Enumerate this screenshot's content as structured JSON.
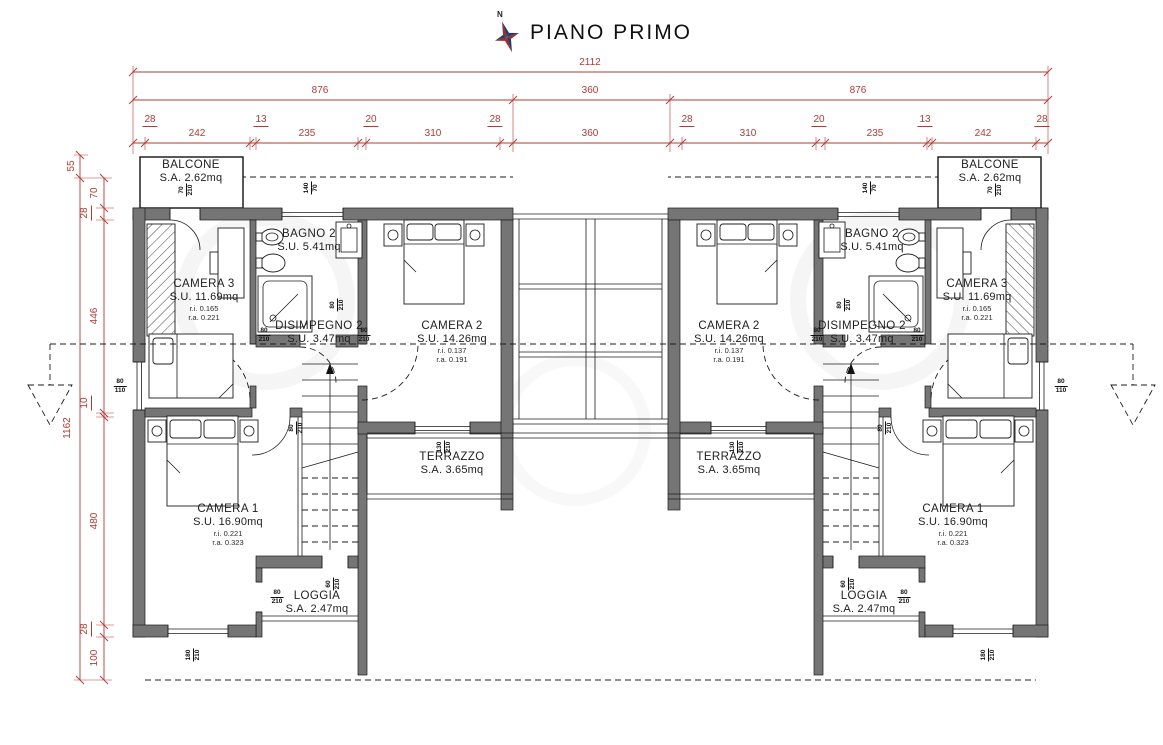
{
  "title": {
    "text": "PIANO PRIMO",
    "north": "N"
  },
  "colors": {
    "dimension_red": "#b23a33",
    "wall_gray": "#757575",
    "ink": "#1c1c1c",
    "compass_red": "#9e2b25",
    "compass_blue": "#1e3d6e"
  },
  "dim_labels": [
    {
      "t": "2112",
      "x": 590,
      "y": 63
    },
    {
      "t": "876",
      "x": 320,
      "y": 91
    },
    {
      "t": "360",
      "x": 590,
      "y": 91
    },
    {
      "t": "876",
      "x": 858,
      "y": 91
    },
    {
      "t": "28",
      "x": 150,
      "y": 121,
      "u": 1
    },
    {
      "t": "242",
      "x": 197,
      "y": 134
    },
    {
      "t": "13",
      "x": 261,
      "y": 121,
      "u": 1
    },
    {
      "t": "235",
      "x": 307,
      "y": 134
    },
    {
      "t": "20",
      "x": 371,
      "y": 121,
      "u": 1
    },
    {
      "t": "310",
      "x": 433,
      "y": 134
    },
    {
      "t": "28",
      "x": 495,
      "y": 121,
      "u": 1
    },
    {
      "t": "360",
      "x": 590,
      "y": 134
    },
    {
      "t": "28",
      "x": 687,
      "y": 121,
      "u": 1
    },
    {
      "t": "310",
      "x": 748,
      "y": 134
    },
    {
      "t": "20",
      "x": 819,
      "y": 121,
      "u": 1
    },
    {
      "t": "235",
      "x": 875,
      "y": 134
    },
    {
      "t": "13",
      "x": 925,
      "y": 121,
      "u": 1
    },
    {
      "t": "242",
      "x": 983,
      "y": 134
    },
    {
      "t": "28",
      "x": 1042,
      "y": 121,
      "u": 1
    },
    {
      "t": "55",
      "x": 72,
      "y": 166,
      "r": 1
    },
    {
      "t": "1162",
      "x": 68,
      "y": 428,
      "r": 1
    },
    {
      "t": "70",
      "x": 95,
      "y": 193,
      "r": 1
    },
    {
      "t": "28",
      "x": 86,
      "y": 213,
      "r": 1,
      "u": 1
    },
    {
      "t": "446",
      "x": 95,
      "y": 316,
      "r": 1
    },
    {
      "t": "10",
      "x": 86,
      "y": 403,
      "r": 1,
      "u": 1
    },
    {
      "t": "480",
      "x": 95,
      "y": 521,
      "r": 1
    },
    {
      "t": "28",
      "x": 86,
      "y": 629,
      "r": 1,
      "u": 1
    },
    {
      "t": "100",
      "x": 95,
      "y": 658,
      "r": 1
    }
  ],
  "room_labels": [
    {
      "n": "balcone-left",
      "cx": 191,
      "y": 159,
      "lines": [
        {
          "t": "BALCONE",
          "c": "name"
        },
        {
          "t": "S.A. 2.62mq",
          "c": "area"
        }
      ]
    },
    {
      "n": "camera3-left",
      "cx": 204,
      "y": 278,
      "lines": [
        {
          "t": "CAMERA 3",
          "c": "name"
        },
        {
          "t": "S.U. 11.69mq",
          "c": "area"
        },
        {
          "t": "r.i. 0.165",
          "c": "small"
        },
        {
          "t": "r.a. 0.221",
          "c": "small"
        }
      ]
    },
    {
      "n": "bagno2-left",
      "cx": 309,
      "y": 228,
      "lines": [
        {
          "t": "BAGNO 2",
          "c": "name"
        },
        {
          "t": "S.U. 5.41mq",
          "c": "area"
        }
      ]
    },
    {
      "n": "disimpegno2-left",
      "cx": 319,
      "y": 320,
      "lines": [
        {
          "t": "DISIMPEGNO 2",
          "c": "name"
        },
        {
          "t": "S.U. 3.47mq",
          "c": "area"
        }
      ]
    },
    {
      "n": "camera2-left",
      "cx": 452,
      "y": 320,
      "lines": [
        {
          "t": "CAMERA 2",
          "c": "name"
        },
        {
          "t": "S.U. 14.26mq",
          "c": "area"
        },
        {
          "t": "r.i. 0.137",
          "c": "small"
        },
        {
          "t": "r.a. 0.191",
          "c": "small"
        }
      ]
    },
    {
      "n": "terrazzo-left",
      "cx": 452,
      "y": 451,
      "lines": [
        {
          "t": "TERRAZZO",
          "c": "name"
        },
        {
          "t": "S.A. 3.65mq",
          "c": "area"
        }
      ]
    },
    {
      "n": "camera1-left",
      "cx": 228,
      "y": 503,
      "lines": [
        {
          "t": "CAMERA 1",
          "c": "name"
        },
        {
          "t": "S.U. 16.90mq",
          "c": "area"
        },
        {
          "t": "r.i. 0.221",
          "c": "small"
        },
        {
          "t": "r.a. 0.323",
          "c": "small"
        }
      ]
    },
    {
      "n": "loggia-left",
      "cx": 317,
      "y": 590,
      "lines": [
        {
          "t": "LOGGIA",
          "c": "name"
        },
        {
          "t": "S.A. 2.47mq",
          "c": "area"
        }
      ]
    },
    {
      "n": "balcone-right",
      "cx": 990,
      "y": 159,
      "lines": [
        {
          "t": "BALCONE",
          "c": "name"
        },
        {
          "t": "S.A. 2.62mq",
          "c": "area"
        }
      ]
    },
    {
      "n": "camera3-right",
      "cx": 977,
      "y": 278,
      "lines": [
        {
          "t": "CAMERA 3",
          "c": "name"
        },
        {
          "t": "S.U. 11.69mq",
          "c": "area"
        },
        {
          "t": "r.i. 0.165",
          "c": "small"
        },
        {
          "t": "r.a. 0.221",
          "c": "small"
        }
      ]
    },
    {
      "n": "bagno2-right",
      "cx": 872,
      "y": 228,
      "lines": [
        {
          "t": "BAGNO 2",
          "c": "name"
        },
        {
          "t": "S.U. 5.41mq",
          "c": "area"
        }
      ]
    },
    {
      "n": "disimpegno2-right",
      "cx": 862,
      "y": 320,
      "lines": [
        {
          "t": "DISIMPEGNO 2",
          "c": "name"
        },
        {
          "t": "S.U. 3.47mq",
          "c": "area"
        }
      ]
    },
    {
      "n": "camera2-right",
      "cx": 729,
      "y": 320,
      "lines": [
        {
          "t": "CAMERA 2",
          "c": "name"
        },
        {
          "t": "S.U. 14.26mq",
          "c": "area"
        },
        {
          "t": "r.i. 0.137",
          "c": "small"
        },
        {
          "t": "r.a. 0.191",
          "c": "small"
        }
      ]
    },
    {
      "n": "terrazzo-right",
      "cx": 729,
      "y": 451,
      "lines": [
        {
          "t": "TERRAZZO",
          "c": "name"
        },
        {
          "t": "S.A. 3.65mq",
          "c": "area"
        }
      ]
    },
    {
      "n": "camera1-right",
      "cx": 953,
      "y": 503,
      "lines": [
        {
          "t": "CAMERA 1",
          "c": "name"
        },
        {
          "t": "S.U. 16.90mq",
          "c": "area"
        },
        {
          "t": "r.i. 0.221",
          "c": "small"
        },
        {
          "t": "r.a. 0.323",
          "c": "small"
        }
      ]
    },
    {
      "n": "loggia-right",
      "cx": 864,
      "y": 590,
      "lines": [
        {
          "t": "LOGGIA",
          "c": "name"
        },
        {
          "t": "S.A. 2.47mq",
          "c": "area"
        }
      ]
    }
  ],
  "opening_labels": [
    {
      "top": "70",
      "bot": "210",
      "x": 186,
      "y": 190,
      "r": 1
    },
    {
      "top": "140",
      "bot": "70",
      "x": 311,
      "y": 188,
      "r": 1
    },
    {
      "top": "80",
      "bot": "110",
      "x": 120,
      "y": 386
    },
    {
      "top": "80",
      "bot": "210",
      "x": 264,
      "y": 335
    },
    {
      "top": "80",
      "bot": "210",
      "x": 364,
      "y": 335
    },
    {
      "top": "80",
      "bot": "210",
      "x": 337,
      "y": 305,
      "r": 1
    },
    {
      "top": "80",
      "bot": "210",
      "x": 296,
      "y": 428,
      "r": 1
    },
    {
      "top": "130",
      "bot": "210",
      "x": 444,
      "y": 447,
      "r": 1
    },
    {
      "top": "80",
      "bot": "210",
      "x": 277,
      "y": 597
    },
    {
      "top": "60",
      "bot": "210",
      "x": 333,
      "y": 584,
      "r": 1
    },
    {
      "top": "180",
      "bot": "210",
      "x": 193,
      "y": 655,
      "r": 1
    },
    {
      "top": "70",
      "bot": "210",
      "x": 995,
      "y": 190,
      "r": 1
    },
    {
      "top": "140",
      "bot": "70",
      "x": 870,
      "y": 188,
      "r": 1
    },
    {
      "top": "80",
      "bot": "110",
      "x": 1061,
      "y": 386
    },
    {
      "top": "80",
      "bot": "210",
      "x": 917,
      "y": 335
    },
    {
      "top": "80",
      "bot": "210",
      "x": 817,
      "y": 335
    },
    {
      "top": "80",
      "bot": "210",
      "x": 844,
      "y": 305,
      "r": 1
    },
    {
      "top": "80",
      "bot": "210",
      "x": 885,
      "y": 428,
      "r": 1
    },
    {
      "top": "130",
      "bot": "210",
      "x": 737,
      "y": 447,
      "r": 1
    },
    {
      "top": "80",
      "bot": "210",
      "x": 904,
      "y": 597
    },
    {
      "top": "60",
      "bot": "210",
      "x": 848,
      "y": 584,
      "r": 1
    },
    {
      "top": "180",
      "bot": "210",
      "x": 988,
      "y": 655,
      "r": 1
    }
  ]
}
